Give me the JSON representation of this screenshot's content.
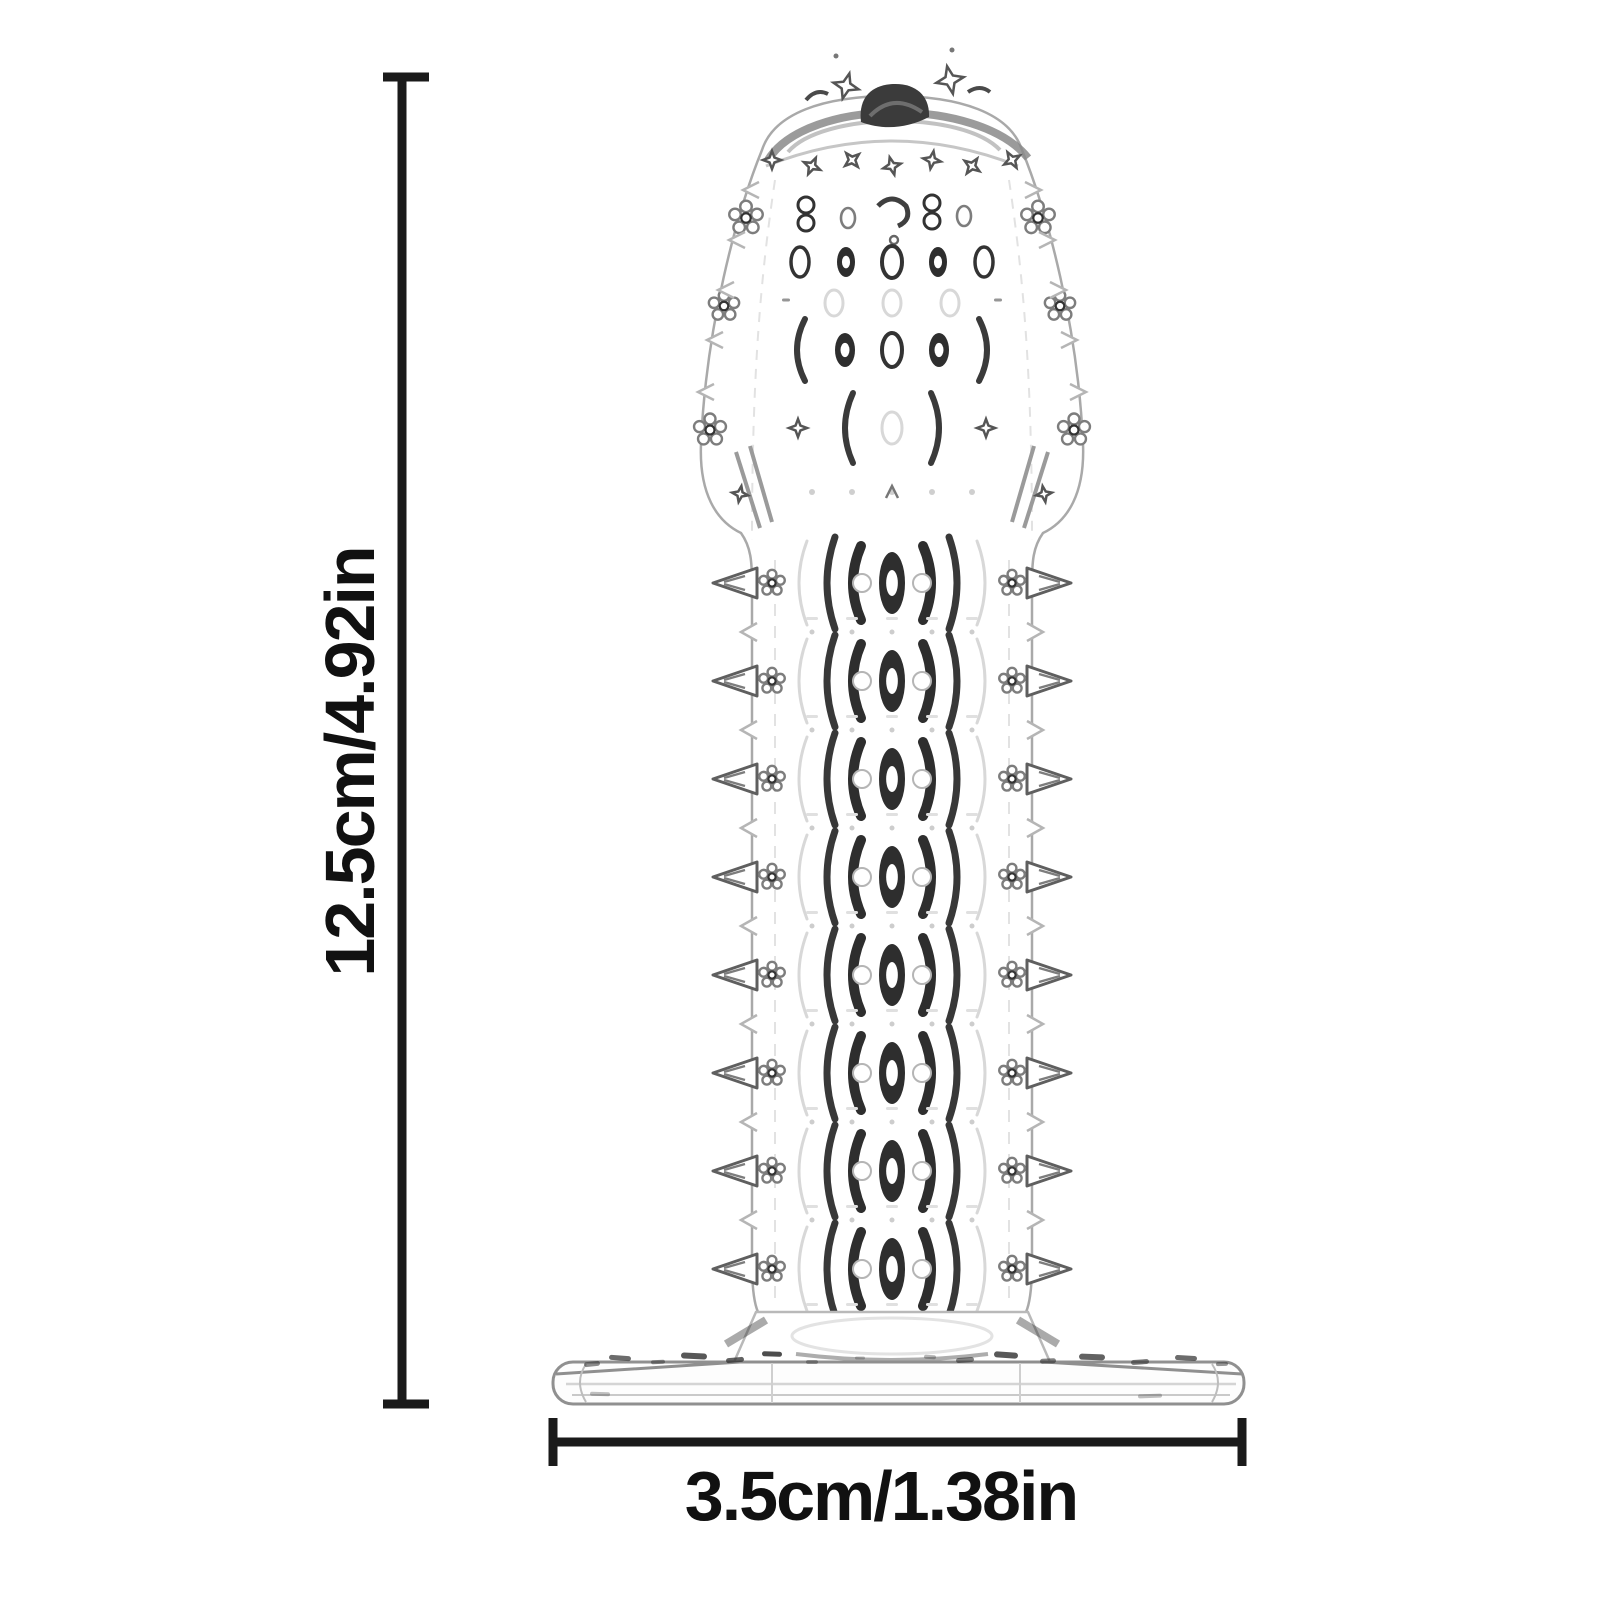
{
  "diagram": {
    "height_label": "12.5cm/4.92in",
    "width_label": "3.5cm/1.38in",
    "colors": {
      "background": "#ffffff",
      "text": "#111111",
      "dimension_line": "#1a1a1a",
      "outline_light": "#b5b5b5",
      "outline_mid": "#7d7d7d",
      "detail_dark": "#2e2e2e",
      "ghost": "#d8d8d8"
    }
  }
}
